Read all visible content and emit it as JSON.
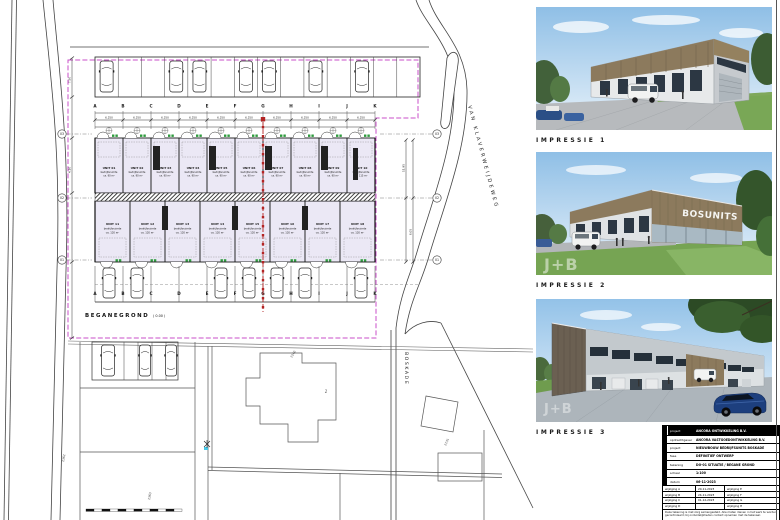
{
  "plan": {
    "floor_label": "BEGANEGROND",
    "floor_level": "( 0.00 )",
    "street_right": "VAN KLAVERWEIJDEWEG",
    "street_bottom": "BOSKADE",
    "building_number": "1",
    "grid_letters": [
      "A",
      "B",
      "C",
      "D",
      "E",
      "F",
      "G",
      "H",
      "I",
      "J",
      "K"
    ],
    "grid_numbers": [
      "03",
      "02",
      "01"
    ],
    "dims": {
      "bay": "6.250",
      "left": [
        "7.50",
        "4.10"
      ],
      "right": [
        "11.95",
        "6.05"
      ]
    },
    "units_top": [
      {
        "name": "UNIT 01",
        "line2": "bedrijfsruimte",
        "line3": "ca. 90 m²"
      },
      {
        "name": "UNIT 02",
        "line2": "bedrijfsruimte",
        "line3": "ca. 90 m²"
      },
      {
        "name": "UNIT 03",
        "line2": "bedrijfsruimte",
        "line3": "ca. 90 m²"
      },
      {
        "name": "UNIT 04",
        "line2": "bedrijfsruimte",
        "line3": "ca. 90 m²"
      },
      {
        "name": "UNIT 05",
        "line2": "bedrijfsruimte",
        "line3": "ca. 90 m²"
      },
      {
        "name": "UNIT 06",
        "line2": "bedrijfsruimte",
        "line3": "ca. 90 m²"
      },
      {
        "name": "UNIT 07",
        "line2": "bedrijfsruimte",
        "line3": "ca. 90 m²"
      },
      {
        "name": "UNIT 08",
        "line2": "bedrijfsruimte",
        "line3": "ca. 90 m²"
      },
      {
        "name": "UNIT 09",
        "line2": "bedrijfsruimte",
        "line3": "ca. 90 m²"
      },
      {
        "name": "UNIT 10",
        "line2": "bedrijfsruimte",
        "line3": "ca. 115 m²"
      }
    ],
    "units_bottom": [
      {
        "name": "UNIT 11",
        "line2": "bedrijfsruimte",
        "line3": "ca. 120 m²"
      },
      {
        "name": "UNIT 12",
        "line2": "bedrijfsruimte",
        "line3": "ca. 120 m²"
      },
      {
        "name": "UNIT 13",
        "line2": "bedrijfsruimte",
        "line3": "ca. 120 m²"
      },
      {
        "name": "UNIT 14",
        "line2": "bedrijfsruimte",
        "line3": "ca. 120 m²"
      },
      {
        "name": "UNIT 15",
        "line2": "bedrijfsruimte",
        "line3": "ca. 120 m²"
      },
      {
        "name": "UNIT 16",
        "line2": "bedrijfsruimte",
        "line3": "ca. 120 m²"
      },
      {
        "name": "UNIT 17",
        "line2": "bedrijfsruimte",
        "line3": "ca. 120 m²"
      },
      {
        "name": "UNIT 18",
        "line2": "bedrijfsruimte",
        "line3": "ca. 120 m²"
      }
    ],
    "parcels": [
      "2362",
      "2363",
      "2240",
      "2131"
    ]
  },
  "impressions": [
    {
      "label": "IMPRESSIE 1"
    },
    {
      "label": "IMPRESSIE 2",
      "sign": "BOSUNITS",
      "watermark": "J+B"
    },
    {
      "label": "IMPRESSIE 3",
      "watermark": "J+B"
    }
  ],
  "titleblock": {
    "rows": [
      {
        "label": "project",
        "value": "ANCORA ONTWIKKELING B.V.",
        "inv": true
      },
      {
        "label": "opdrachtgever",
        "value": "ANCORA VASTGOEDONTWIKKELING B.V.",
        "inv": false
      },
      {
        "label": "project",
        "value": "NIEUWBOUW BEDRIJFSUNITS BOSKADE",
        "inv": false
      },
      {
        "label": "fase",
        "value": "DEFINITIEF ONTWERP",
        "inv": false
      },
      {
        "label": "tekening",
        "value": "DO-01  SITUATIE / BEGANE GROND",
        "inv": false
      },
      {
        "label": "schaal",
        "value": "1:100",
        "inv": false
      },
      {
        "label": "datum",
        "value": "06-11-2023",
        "inv": false
      }
    ],
    "revisions": [
      {
        "left": "wijziging A",
        "date": "20-11-2023",
        "right": "wijziging E"
      },
      {
        "left": "wijziging B",
        "date": "24-11-2023",
        "right": "wijziging F"
      },
      {
        "left": "wijziging C",
        "date": "01-12-2023",
        "right": "wijziging G"
      },
      {
        "left": "wijziging D",
        "date": "",
        "right": "wijziging H"
      }
    ],
    "note": "Deze tekening is met zorg samengesteld. Alle maten dienen in het werk te worden gecontroleerd; bij onduidelijkheden contact opnemen met de tekenaar.",
    "brand": "J+B bouwkundig",
    "accent": "#c9a227"
  },
  "colors": {
    "boundary": "#c94fc9",
    "section": "#b32424",
    "unit_fill": "#ebe8f5",
    "entrance_green": "#2e9b3e"
  }
}
